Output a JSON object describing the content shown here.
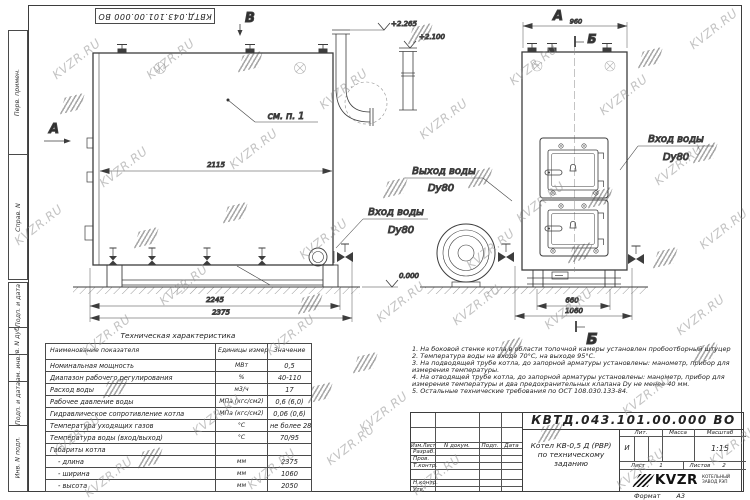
{
  "sheet": {
    "doc_number_top": "КВТД.043.101.00.000 ВО",
    "margin_labels": [
      "Перв. примен.",
      "Справ. N",
      "Подп. и дата",
      "Инв. N дубл.",
      "Взам. инв. N",
      "Подп. и дата",
      "Инв. N подл."
    ]
  },
  "watermark": {
    "text": "KVZR.RU",
    "text_positions": [
      [
        48,
        52
      ],
      [
        10,
        218
      ],
      [
        95,
        160
      ],
      [
        225,
        142
      ],
      [
        315,
        82
      ],
      [
        295,
        232
      ],
      [
        155,
        278
      ],
      [
        415,
        112
      ],
      [
        505,
        58
      ],
      [
        595,
        88
      ],
      [
        685,
        22
      ],
      [
        650,
        158
      ],
      [
        695,
        222
      ],
      [
        462,
        242
      ],
      [
        540,
        302
      ],
      [
        672,
        308
      ],
      [
        48,
        428
      ],
      [
        188,
        408
      ],
      [
        322,
        438
      ],
      [
        448,
        298
      ],
      [
        618,
        388
      ],
      [
        705,
        438
      ],
      [
        262,
        328
      ],
      [
        408,
        468
      ],
      [
        78,
        328
      ],
      [
        612,
        462
      ],
      [
        142,
        52
      ],
      [
        372,
        295
      ],
      [
        243,
        462
      ],
      [
        512,
        195
      ],
      [
        355,
        405
      ],
      [
        80,
        470
      ]
    ],
    "logo_positions": [
      [
        62,
        96
      ],
      [
        136,
        230
      ],
      [
        300,
        296
      ],
      [
        240,
        54
      ],
      [
        385,
        180
      ],
      [
        470,
        170
      ],
      [
        590,
        190
      ],
      [
        640,
        50
      ],
      [
        695,
        145
      ],
      [
        140,
        450
      ],
      [
        310,
        385
      ],
      [
        540,
        425
      ],
      [
        695,
        345
      ],
      [
        410,
        26
      ],
      [
        570,
        245
      ],
      [
        355,
        355
      ],
      [
        225,
        205
      ],
      [
        500,
        340
      ],
      [
        655,
        250
      ],
      [
        105,
        380
      ]
    ]
  },
  "drawing": {
    "left_view": {
      "label_top": "В",
      "label_left": "А",
      "callout_note": "см. п. 1",
      "dim_width_inner": "2115",
      "dim_base": "2245",
      "dim_total": "2375",
      "outlet_label": "Выход воды",
      "outlet_dn": "Dy80",
      "inlet_label": "Вход воды",
      "inlet_dn": "Dy80",
      "elev_pipe": "+2.265",
      "elev_duct": "+2.100",
      "elev_ground": "0.000"
    },
    "right_view": {
      "label_top": "А",
      "section_mark": "Б",
      "dim_top": "960",
      "dim_base": "660",
      "dim_total": "1060",
      "inlet_label": "Вход воды",
      "inlet_dn": "Dy80"
    }
  },
  "spec_table": {
    "title": "Техническая характеристика",
    "headers": [
      "Наименование показателя",
      "Единицы измерения",
      "Значение"
    ],
    "rows": [
      [
        "Номинальная мощность",
        "МВт",
        "0,5"
      ],
      [
        "Диапазон рабочего регулирования",
        "%",
        "40-110"
      ],
      [
        "Расход воды",
        "м3/ч",
        "17"
      ],
      [
        "Рабочее давление воды",
        "МПа (кгс/см2)",
        "0,6 (6,0)"
      ],
      [
        "Гидравлическое сопротивление котла",
        "МПа (кгс/см2)",
        "0,06 (0,6)"
      ],
      [
        "Температура уходящих газов",
        "°С",
        "не более 280"
      ],
      [
        "Температура воды (вход/выход)",
        "°С",
        "70/95"
      ],
      [
        "Габариты котла",
        "",
        ""
      ],
      [
        "- длина",
        "мм",
        "2375"
      ],
      [
        "- ширина",
        "мм",
        "1060"
      ],
      [
        "- высота",
        "мм",
        "2050"
      ]
    ]
  },
  "notes": {
    "items": [
      "1.  На боковой стенке котла в области топочной камеры установлен пробоотборный штуцер",
      "2.  Температура воды на входе 70°С, на выходе 95°С.",
      "3.  На подводящей трубе котла, до запорной арматуры установлены: манометр, прибор для измерения температуры.",
      "4.  На отводящей трубе котла, до запорной арматуры установлены: манометр, прибор для измерения температуры и два предохранительных клапана Dу не менее 40 мм.",
      "5.  Остальные технические требования по ОСТ 108.030.133-84."
    ]
  },
  "title_block": {
    "doc_number": "КВТД.043.101.00.000 ВО",
    "cols": [
      "Изм.Лист",
      "N докум.",
      "Подп.",
      "Дата"
    ],
    "rows": [
      "Разраб.",
      "Пров.",
      "Т.контр.",
      "Н.контр.",
      "Утв."
    ],
    "name_line1": "Котел КВ-0,5 Д (РВР)",
    "name_line2": "по техническому заданию",
    "lit_label": "Лит.",
    "mass_label": "Масса",
    "scale_label": "Масштаб",
    "lit_value": "И",
    "scale_value": "1:15",
    "sheet_label": "Лист",
    "sheet_value": "1",
    "sheets_label": "Листов",
    "sheets_value": "2",
    "logo_text": "KVZR",
    "logo_sub1": "КОТЕЛЬНЫЙ",
    "logo_sub2": "ЗАВОД РЭП",
    "format_label": "Формат",
    "format_value": "А3"
  }
}
